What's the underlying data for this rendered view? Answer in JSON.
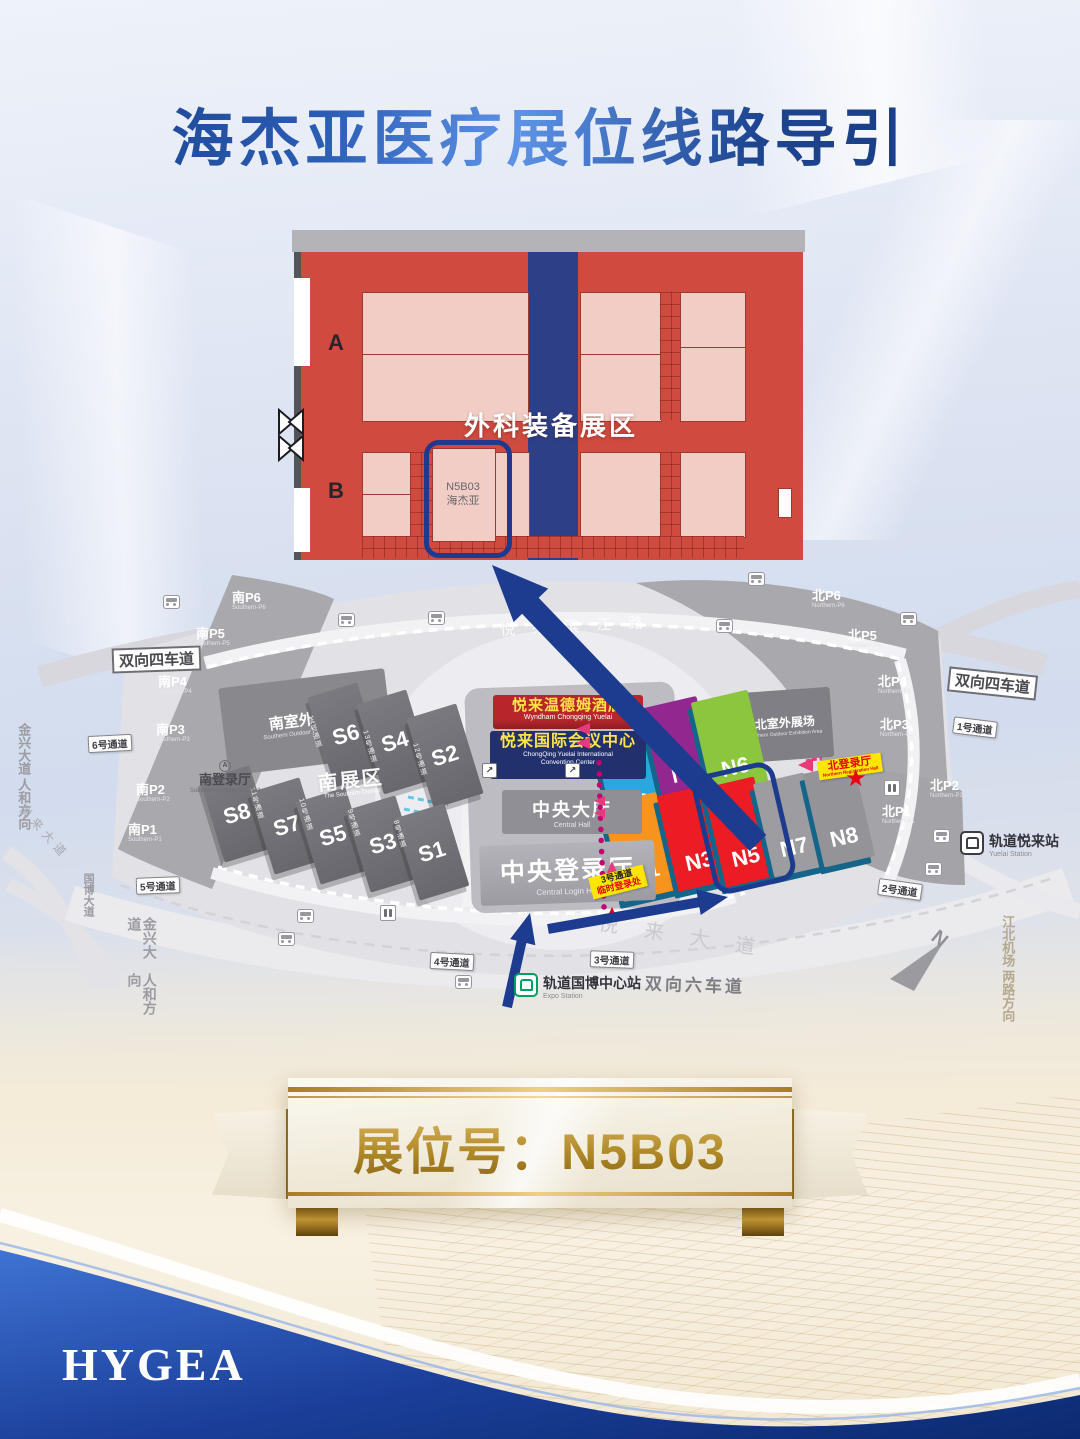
{
  "title": "海杰亚医疗展位线路导引",
  "hall_map": {
    "zone": "外科装备展区",
    "booth_id": "N5B03",
    "booth_name": "海杰亚",
    "rows": {
      "a": "A",
      "b": "B"
    }
  },
  "map": {
    "roads": {
      "binjiang_road": "悦来滨江路",
      "four_lane_left": "双向四车道",
      "four_lane_right": "双向四车道",
      "six_lane": "双向六车道",
      "yuelai_avenue": "悦来大道",
      "yuelai_avenue_west": "悦来大道",
      "guobo_avenue": "国博大道",
      "jinxing_avenue": "金兴大道",
      "renhe_direction": "人和方向",
      "jinxing_avenue2": "金兴大道",
      "renhe_direction2": "人和方向",
      "airport": "江北机场",
      "lianglu_direction": "两路方向",
      "compass_n": "N"
    },
    "entrances": {
      "e1": "1号通道",
      "e2": "2号通道",
      "e3": "3号通道",
      "e4": "4号通道",
      "e5": "5号通道",
      "e6": "6号通道"
    },
    "passages": {
      "p8": "8号通道",
      "p9": "9号通道",
      "p10": "10号通道",
      "p11": "11号通道",
      "p12": "12号通道",
      "p13": "13号通道",
      "p14": "14号通道"
    },
    "south": {
      "p1": {
        "label": "南P1",
        "sub": "Southern-P1"
      },
      "p2": {
        "label": "南P2",
        "sub": "Southern-P2"
      },
      "p3": {
        "label": "南P3",
        "sub": "Southern-P3"
      },
      "p4": {
        "label": "南P4",
        "sub": "Southern-P4"
      },
      "p5": {
        "label": "南P5",
        "sub": "Southern-P5"
      },
      "p6": {
        "label": "南P6",
        "sub": "Southern-P6"
      },
      "outdoor": {
        "label": "南室外展场",
        "sub": "Southern Outdoor Exhibition Area"
      },
      "registration": {
        "label": "南登录厅",
        "sub": "Southern Registration Hall",
        "badge": "A"
      },
      "district": {
        "label": "南展区",
        "sub": "The Southern District"
      },
      "halls": {
        "s1": "S1",
        "s2": "S2",
        "s3": "S3",
        "s4": "S4",
        "s5": "S5",
        "s6": "S6",
        "s7": "S7",
        "s8": "S8"
      }
    },
    "north": {
      "p1": {
        "label": "北P1",
        "sub": "Northern-P1"
      },
      "p2": {
        "label": "北P2",
        "sub": "Northern-P2"
      },
      "p3": {
        "label": "北P3",
        "sub": "Northern-P3"
      },
      "p4": {
        "label": "北P4",
        "sub": "Northern-P4"
      },
      "p5": {
        "label": "北P5",
        "sub": "Northern-P5"
      },
      "p6": {
        "label": "北P6",
        "sub": "Northern-P6"
      },
      "outdoor": {
        "label": "北室外展场",
        "sub": "Northern Outdoor Exhibition Area"
      },
      "registration": {
        "label": "北登录厅",
        "sub": "Northern Registration Hall"
      },
      "halls": {
        "n1": "N1",
        "n2": "N2",
        "n3": "N3",
        "n4": "N4",
        "n5": "N5",
        "n6": "N6",
        "n7": "N7",
        "n8": "N8"
      }
    },
    "center": {
      "hotel": {
        "label": "悦来温德姆酒店",
        "sub": "Wyndham Chongqing Yuelai"
      },
      "convention": {
        "label": "悦来国际会议中心",
        "sub": "ChongQing Yuelai International Convention Center"
      },
      "central_hall": {
        "label": "中央大厅",
        "sub": "Central Hall"
      },
      "central_login": {
        "label": "中央登录厅",
        "sub": "Central Login Hall"
      }
    },
    "stations": {
      "yuelai": {
        "label": "轨道悦来站",
        "sub": "Yuelai Station"
      },
      "expo": {
        "label": "轨道国博中心站",
        "sub": "Expo Station"
      }
    },
    "notes": {
      "passage3": "3号通道",
      "temp_reg": "临时登录处"
    }
  },
  "banner": "展位号：N5B03",
  "logo": "HYGEA",
  "colors": {
    "accent_navy": "#1c3a8e",
    "hall_red": "#cf4a3f",
    "booth_pink": "#f2cdc6",
    "n1": "#f7941d",
    "n2": "#29a8e0",
    "n3": "#ec1c24",
    "n4": "#92278f",
    "n5": "#ec1c24",
    "n6": "#8cc63f",
    "n7": "#9d9da1",
    "n8": "#939398",
    "route_dot": "#c0076e",
    "arrow_pink": "#e8397a",
    "gold": "#a5791c",
    "label_yellow": "#ffe600",
    "star_red": "#e60012"
  }
}
